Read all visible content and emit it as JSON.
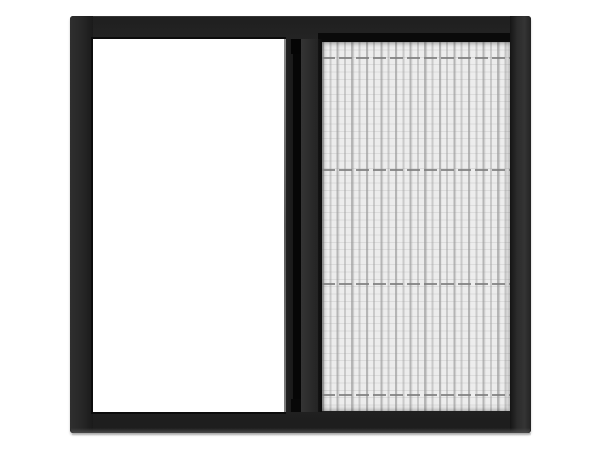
{
  "meta": {
    "type": "product-photo",
    "subject": "sliding pleated insect screen window with dark frame",
    "canvas": {
      "width": 600,
      "height": 450
    }
  },
  "scene": {
    "background_color": "#ffffff"
  },
  "window": {
    "frame": {
      "color": "#272727",
      "edge_dark": "#0c0c0c",
      "bottom_edge_light": "#4a4a4a",
      "left": 70,
      "top": 16,
      "width": 461,
      "height": 417
    },
    "glass": {
      "color": "#ffffff",
      "left": 23,
      "top": 23,
      "width": 191,
      "height": 373
    },
    "slider": {
      "rail_color": "#191919",
      "groove_color": "#060606",
      "handle_color": "#2d2d2d",
      "highlight_color": "#6f6f6f"
    },
    "top_track": {
      "color": "#0a0a0a"
    },
    "mesh": {
      "base_color": "#e9e9e9",
      "pleat_dark": "#b5b5b5",
      "pleat_mid": "#c9c9c9",
      "pleat_period_px": 14.6,
      "left": 252,
      "top": 26,
      "width": 188,
      "height": 369,
      "cords": {
        "color": "#7e7e7e",
        "dash_px": 13,
        "gap_px": 4,
        "positions_y": [
          15,
          127,
          241,
          352
        ]
      }
    },
    "floor_shadow_color": "#8c8c8c"
  }
}
